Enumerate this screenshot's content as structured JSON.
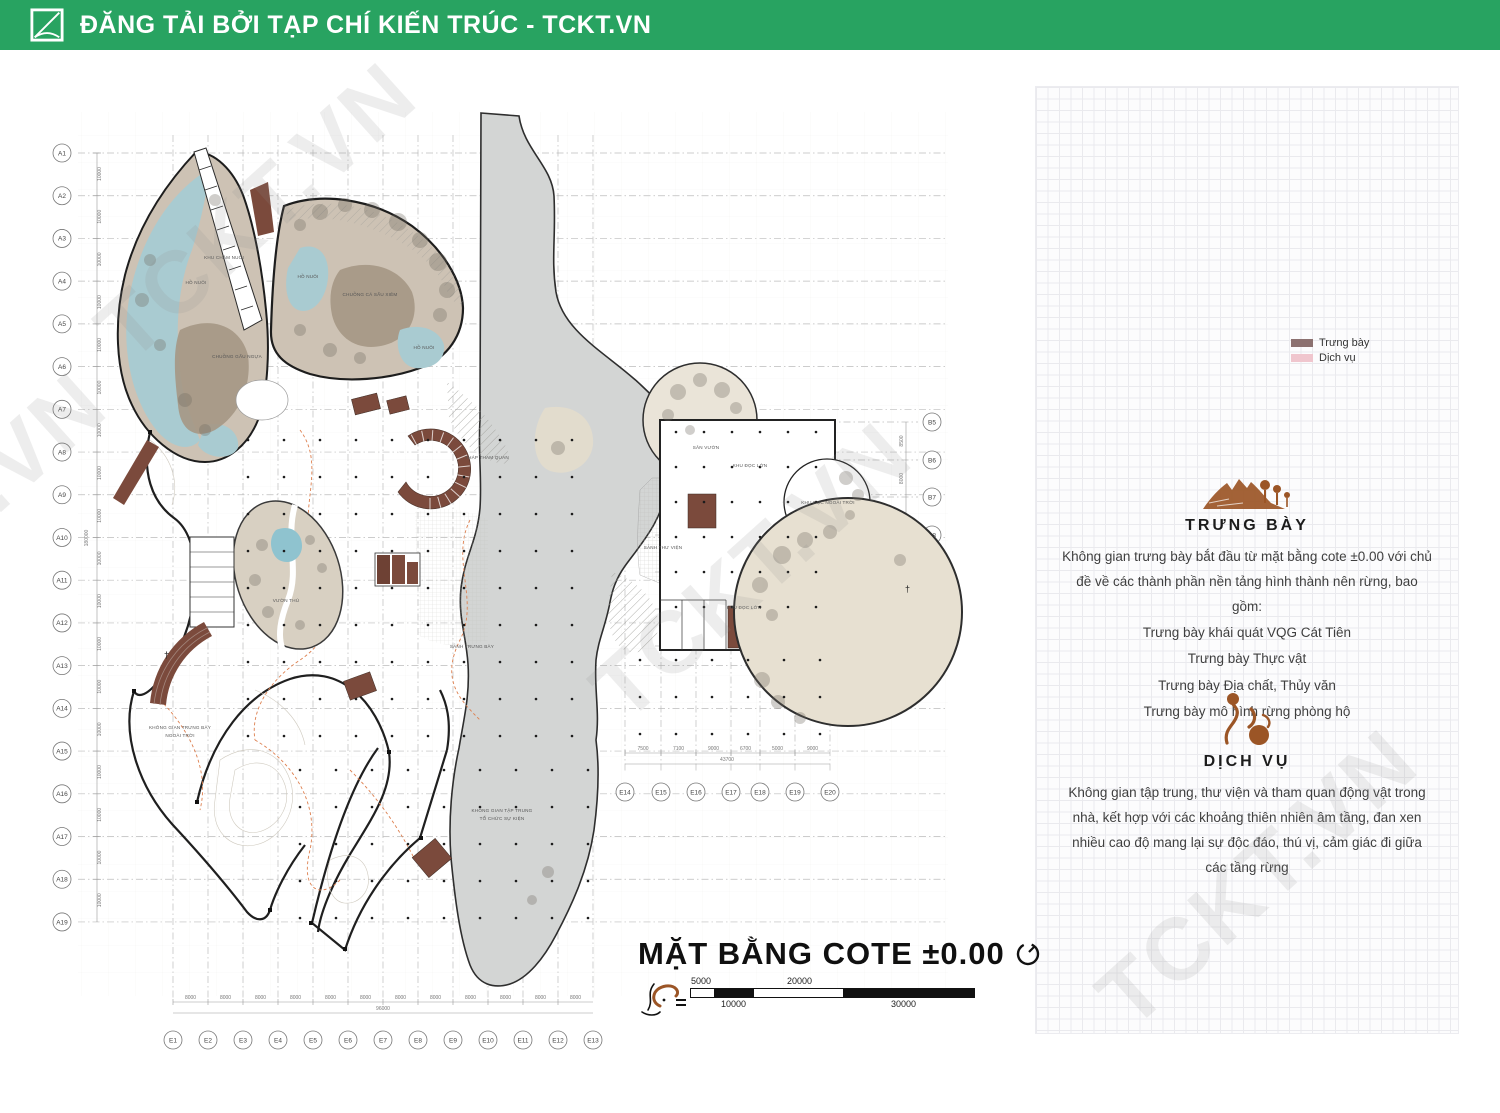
{
  "header": {
    "title": "ĐĂNG TẢI BỞI TẠP CHÍ KIẾN TRÚC - TCKT.VN"
  },
  "watermark": "TCKT.VN",
  "colors": {
    "header_green": "#28A361",
    "accent_sienna": "#9B5526",
    "plan_brown": "#7B4A3C",
    "plan_tan": "#CDC2B4",
    "plan_water": "#A9CBD1",
    "plan_gray_band": "#D3D5D4",
    "legend_exhibit": "#8C7170",
    "legend_service": "#F0C6CE"
  },
  "plan": {
    "title": "MẶT BẰNG COTE ±0.00",
    "north_cross": "†",
    "axes": {
      "left": {
        "labels": [
          "A1",
          "A2",
          "A3",
          "A4",
          "A5",
          "A6",
          "A7",
          "A8",
          "A9",
          "A10",
          "A11",
          "A12",
          "A13",
          "A14",
          "A15",
          "A16",
          "A17",
          "A18",
          "A19"
        ],
        "dims": [
          "10000",
          "10000",
          "10000",
          "10000",
          "10000",
          "10000",
          "10000",
          "10000",
          "10000",
          "10000",
          "10000",
          "10000",
          "10000",
          "10000",
          "10000",
          "10000",
          "10000",
          "10000"
        ],
        "total": "180000"
      },
      "bottom": {
        "labels": [
          "E1",
          "E2",
          "E3",
          "E4",
          "E5",
          "E6",
          "E7",
          "E8",
          "E9",
          "E10",
          "E11",
          "E12",
          "E13"
        ],
        "dims": [
          "8000",
          "8000",
          "8000",
          "8000",
          "8000",
          "8000",
          "8000",
          "8000",
          "8000",
          "8000",
          "8000",
          "8000"
        ],
        "total": "96000"
      },
      "bottom2": {
        "labels": [
          "E14",
          "E15",
          "E16",
          "E17",
          "E18",
          "E19",
          "E20"
        ],
        "dims": [
          "7500",
          "7100",
          "9000",
          "6700",
          "5000",
          "9000"
        ],
        "total": "43700"
      },
      "right": {
        "labels": [
          "B5",
          "B6",
          "B7",
          "B8",
          "B9",
          "B10",
          "B11"
        ],
        "dims": [
          "8500",
          "8000",
          "8000",
          "8000",
          "8000",
          "8000"
        ]
      }
    },
    "labels": [
      {
        "t": "CHUỒNG GẤU NGỰA",
        "x": 237,
        "y": 358
      },
      {
        "t": "HỒ NUÔI",
        "x": 196,
        "y": 284
      },
      {
        "t": "CHUỒNG CÁ SẤU XIÊM",
        "x": 370,
        "y": 296
      },
      {
        "t": "HỒ NUÔI",
        "x": 308,
        "y": 278
      },
      {
        "t": "HỒ NUÔI",
        "x": 424,
        "y": 349
      },
      {
        "t": "KHU CHĂM NUÔI",
        "x": 224,
        "y": 259
      },
      {
        "t": "THÁP THAM QUAN",
        "x": 487,
        "y": 459
      },
      {
        "t": "SẢNH TRƯNG BÀY",
        "x": 472,
        "y": 648
      },
      {
        "t": "SẢNH THƯ VIỆN",
        "x": 663,
        "y": 549
      },
      {
        "t": "KHU ĐỌC LỚN",
        "x": 750,
        "y": 467
      },
      {
        "t": "KHU ĐỌC NGOÀI TRỜI",
        "x": 828,
        "y": 504
      },
      {
        "t": "KHU ĐỌC LỚN",
        "x": 744,
        "y": 609
      },
      {
        "t": "SÂN VƯỜN",
        "x": 706,
        "y": 449
      },
      {
        "t": "KHÔNG GIAN TẬP TRUNG",
        "x": 502,
        "y": 812
      },
      {
        "t": "TỔ CHỨC SỰ KIỆN",
        "x": 502,
        "y": 820
      },
      {
        "t": "KHÔNG GIAN TRƯNG BÀY",
        "x": 180,
        "y": 729
      },
      {
        "t": "NGOÀI TRỜI",
        "x": 180,
        "y": 737
      },
      {
        "t": "VƯỜN THÚ",
        "x": 286,
        "y": 602
      }
    ],
    "scalebar": {
      "above": [
        "5000",
        "20000"
      ],
      "below": [
        "10000",
        "30000"
      ]
    }
  },
  "panel": {
    "legend": [
      {
        "label": "Trưng bày",
        "color": "#8C7170"
      },
      {
        "label": "Dịch vụ",
        "color": "#F0C6CE"
      }
    ],
    "sections": [
      {
        "heading": "TRƯNG BÀY",
        "body": "Không gian trưng bày bắt đầu từ mặt bằng cote ±0.00 với chủ đề về các thành phần nền tảng hình thành nên rừng, bao gồm:",
        "items": [
          "Trưng bày khái quát VQG Cát Tiên",
          "Trưng bày Thực vật",
          "Trưng bày Địa chất, Thủy văn",
          "Trưng bày mô hình rừng phòng hộ"
        ]
      },
      {
        "heading": "DỊCH VỤ",
        "body": "Không gian tập trung, thư viện và tham quan động vật trong nhà, kết hợp với các khoảng thiên nhiên âm tầng, đan xen nhiều cao độ mang lại sự độc đáo, thú vị, cảm giác đi giữa các tầng rừng",
        "items": []
      }
    ]
  }
}
